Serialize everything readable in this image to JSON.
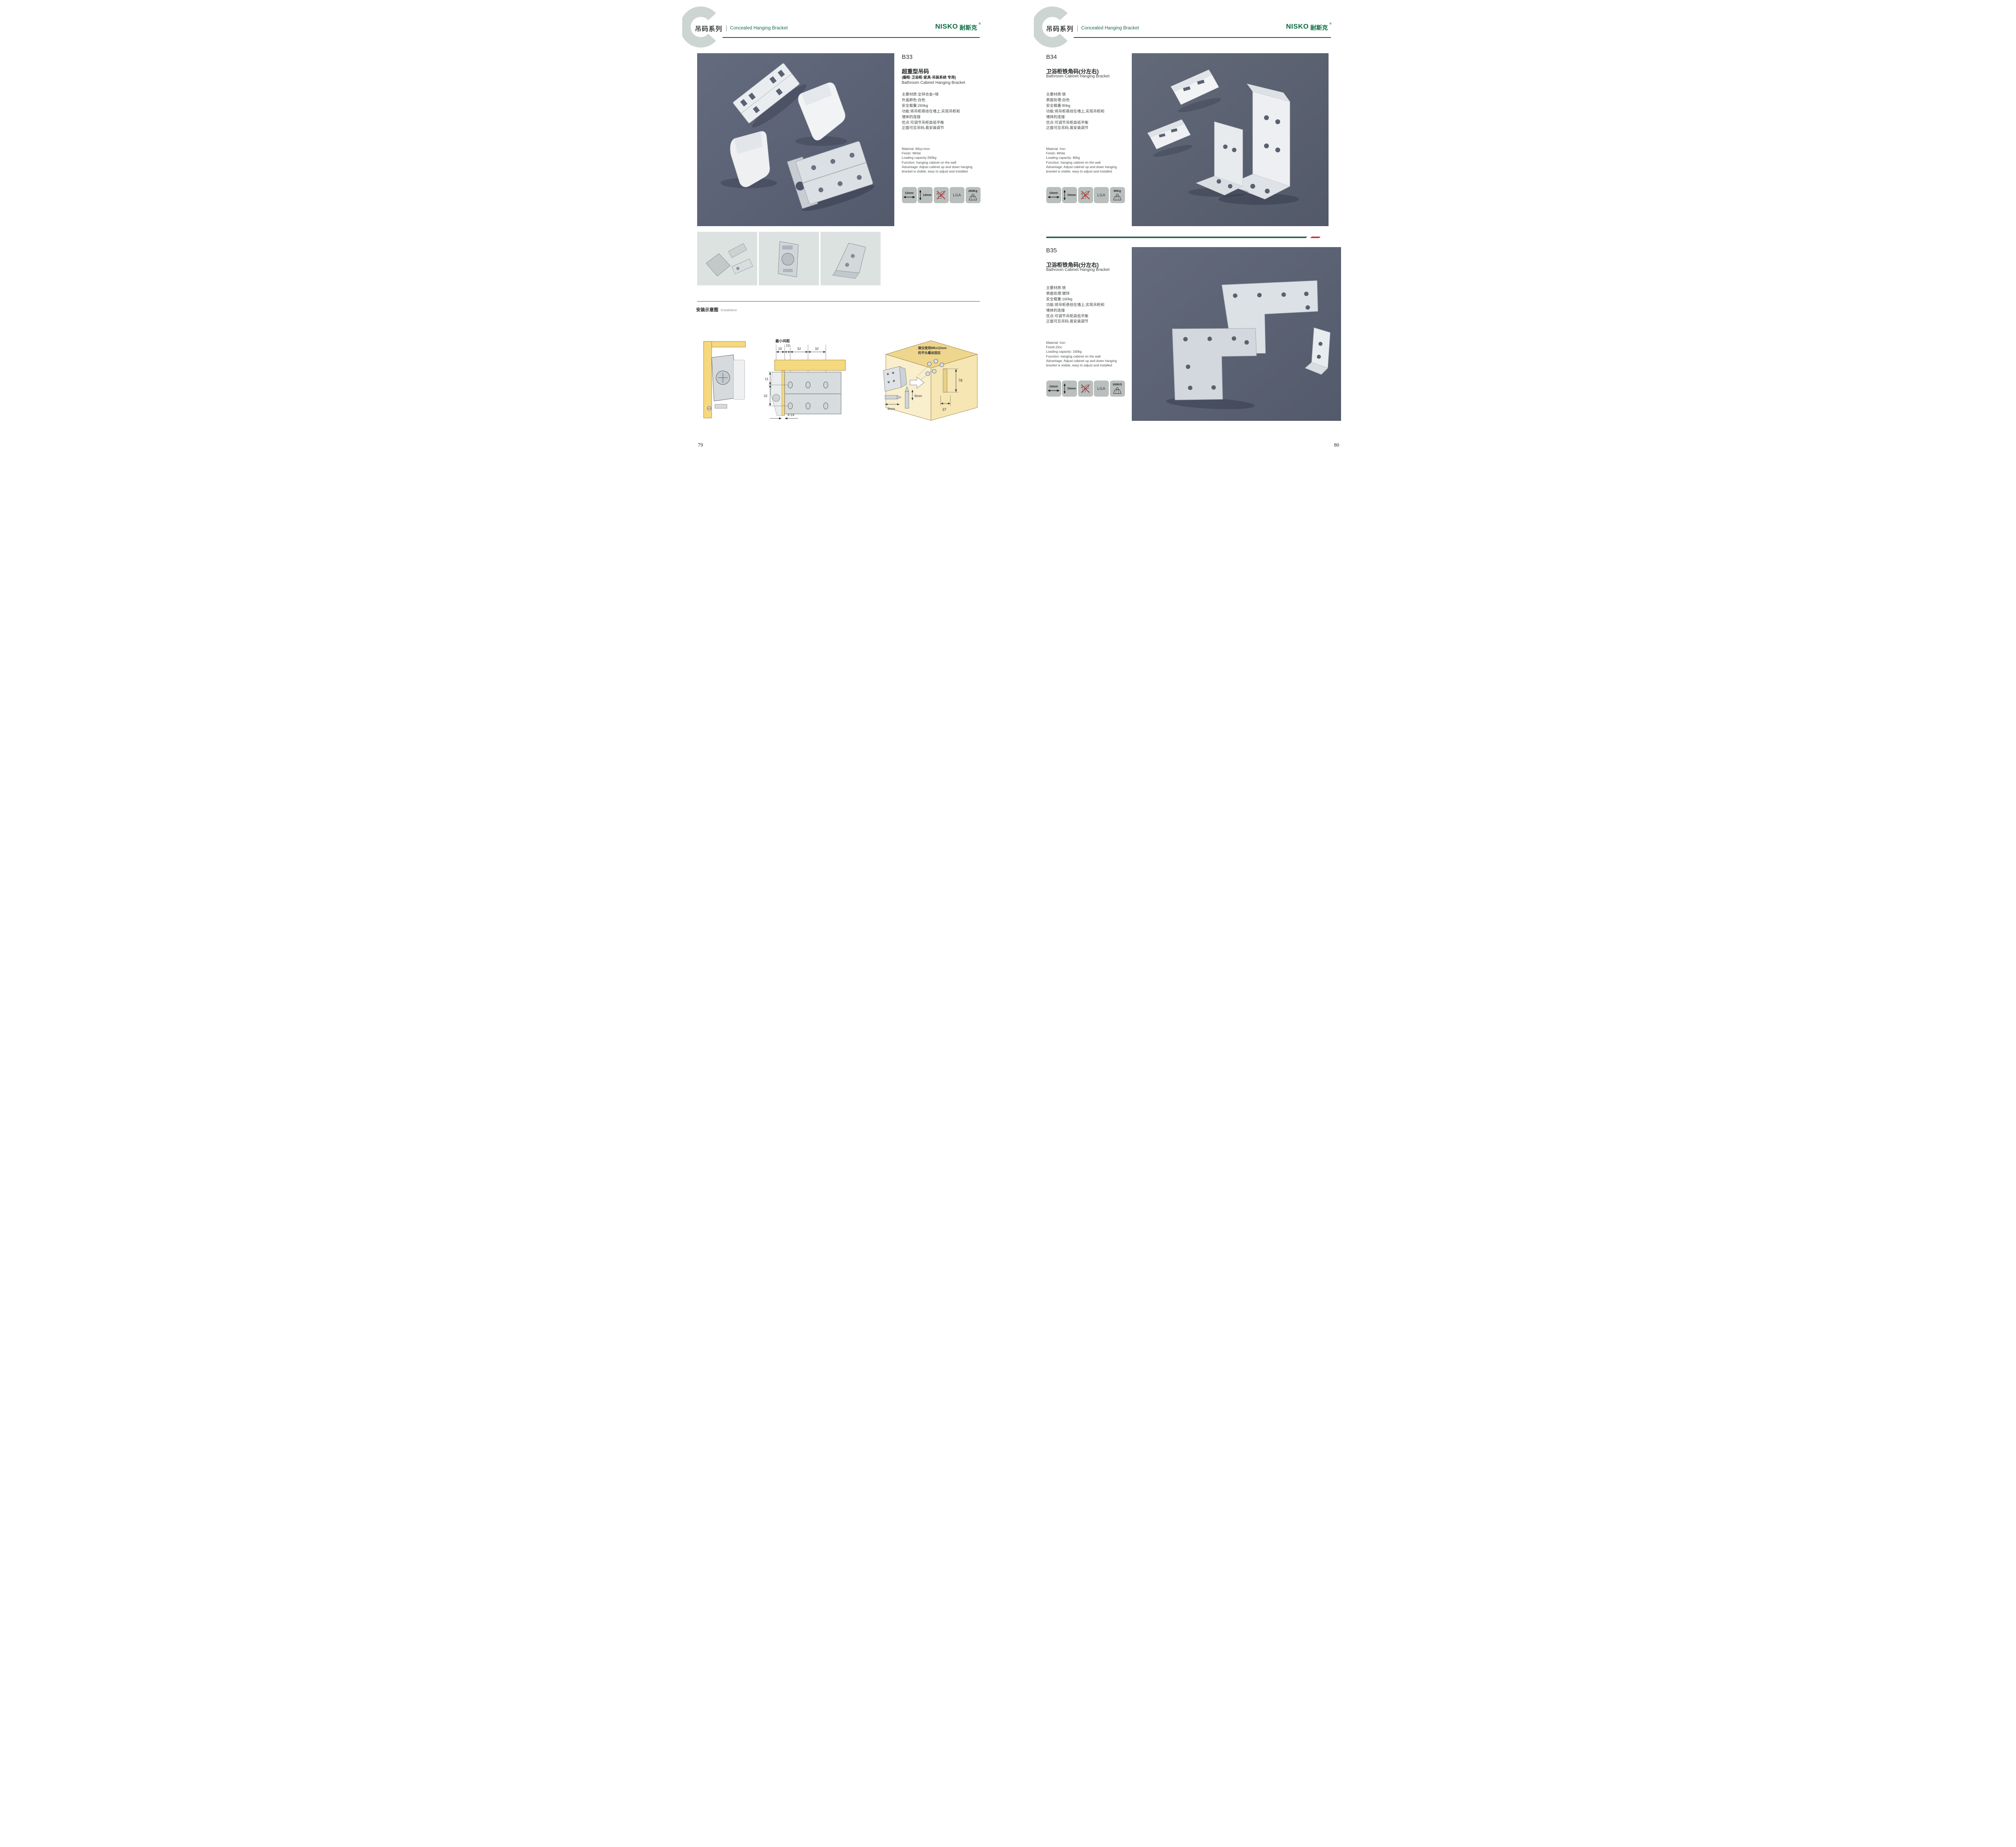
{
  "brand": {
    "logo_en": "NISKO",
    "logo_cn": "耐斯克",
    "registered": "®"
  },
  "header": {
    "series_cn": "吊码系列",
    "series_en": "Concealed Hanging Bracket",
    "watermark_letter": "C"
  },
  "page_left": {
    "page_number": "79",
    "product": {
      "code": "B33",
      "title_cn": "超重型吊码",
      "subtitle_cn": "(橱柜·卫浴柜·家具·吊装系统 专用)",
      "title_en": "Bathroom Cabinet Hanging Bracket",
      "specs_cn": [
        "主要材质:全锌合金+铁",
        "外盖颜色:白色",
        "安全载重:260kg",
        "功能:将吊柜悬挂在墙上,实现吊柜和",
        "墙体的连接",
        "优点:可调节吊柜高低平衡",
        "正面可见吊码,易安装调节"
      ],
      "specs_en": [
        "Material: Alloy+iron",
        "Finish: White",
        "Loading capacity:260kg",
        "Function: hanging cabinet on the wall",
        "Advantage: Adjust cabinet up and down hanging",
        "bracket is visible, easy to adjust and installed"
      ],
      "badges": {
        "hole_width": "12mm",
        "hole_height": "13mm",
        "cert": "LGA",
        "load": "260Kg"
      }
    },
    "installation": {
      "title_cn": "安装示意图",
      "title_en": "Installation",
      "mid": {
        "min_gap": "最小间距",
        "d20": "20",
        "d10": "10",
        "d32a": "32",
        "d32b": "32",
        "d11": "11",
        "d32v": "32",
        "d4_14": "4-14"
      },
      "right": {
        "note1": "建议使用M6x12mm",
        "note2": "的平头螺丝固定",
        "d78": "78",
        "d37": "37",
        "d9a": "9mm",
        "d9b": "9mm"
      }
    }
  },
  "page_right": {
    "page_number": "80",
    "product_top": {
      "code": "B34",
      "title_cn": "卫浴柜铁角码(分左右)",
      "title_en": "Bathroom Cabinet Hanging Bracket",
      "specs_cn": [
        "主要材质:铁",
        "表面处理:白色",
        "安全载重:80kg",
        "功能:将吊柜悬挂在墙上,实现吊柜和",
        "墙体的连接",
        "优点:可调节吊柜高低平衡",
        "正面可见吊码,易安装调节"
      ],
      "specs_en": [
        "Material: Iron",
        "Finish: White",
        "Loading capacity: 80kg",
        "Function: hanging cabinet on the wall",
        "Advantage: Adjust cabinet up and down hanging",
        "bracket is visible, easy to adjust and installed"
      ],
      "badges": {
        "hole_width": "10mm",
        "hole_height": "15mm",
        "cert": "LGA",
        "load": "80Kg"
      }
    },
    "product_bottom": {
      "code": "B35",
      "title_cn": "卫浴柜铁角码(分左右)",
      "title_en": "Bathroom Cabinet Hanging Bracket",
      "specs_cn": [
        "主要材质:铁",
        "表面处理:镀锌",
        "安全载重:160kg",
        "功能:将吊柜悬挂在墙上,实现吊柜和",
        "墙体的连接",
        "优点:可调节吊柜高低平衡",
        "正面可见吊码,易安装调节"
      ],
      "specs_en": [
        "Material: Iron",
        "Finish:Zinc",
        "Loading capacity: 160kg",
        "Function: hanging cabinet on the wall",
        "Advantage: Adjust cabinet up and down hanging",
        "bracket is visible, easy to adjust and installed"
      ],
      "badges": {
        "hole_width": "10mm",
        "hole_height": "15mm",
        "cert": "LGA",
        "load": "160KG"
      }
    }
  }
}
